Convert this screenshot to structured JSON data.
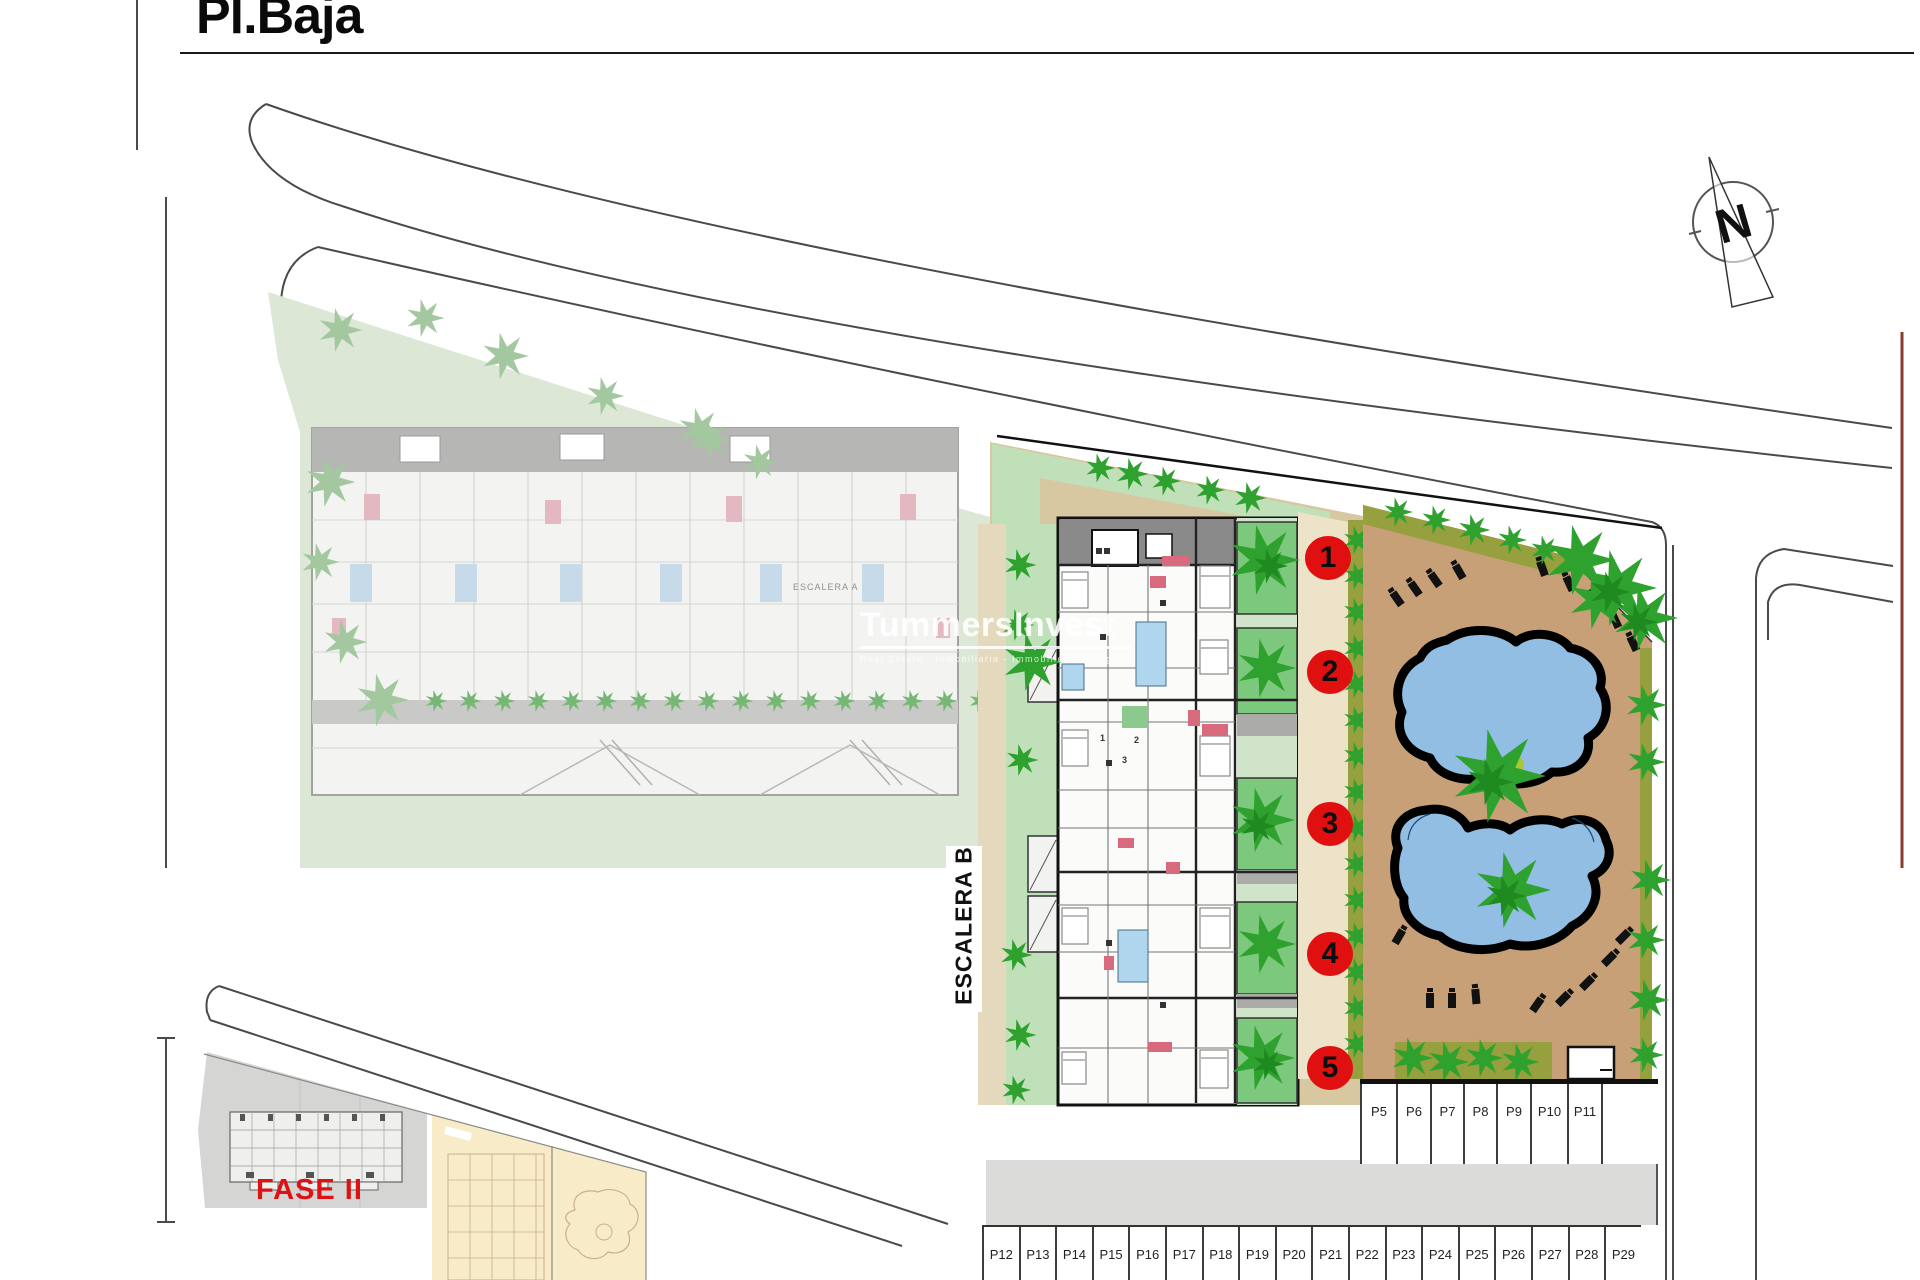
{
  "title": "Pl.Baja",
  "compass": {
    "letter": "N"
  },
  "watermark": {
    "brand": "TummersInvest",
    "tagline": "Real Estate - Inmobiliaria - Immobilien - Vastgoed"
  },
  "labels": {
    "escalera_b": "ESCALERA B",
    "escalera_a": "ESCALERA A",
    "fase2": "FASE II"
  },
  "unit_markers": [
    "1",
    "2",
    "3",
    "4",
    "5"
  ],
  "building_numbers": [
    "1",
    "2",
    "3"
  ],
  "parking_upper": [
    "P5",
    "P6",
    "P7",
    "P8",
    "P9",
    "P10",
    "P11"
  ],
  "parking_lower": [
    "P12",
    "P13",
    "P14",
    "P15",
    "P16",
    "P17",
    "P18",
    "P19",
    "P20",
    "P21",
    "P22",
    "P23",
    "P24",
    "P25",
    "P26",
    "P27",
    "P28",
    "P29"
  ],
  "colors": {
    "marker_red": "#E01010",
    "fase_red": "#DE1212",
    "pool_blue": "#92BEE4",
    "deck_tan": "#C7A078",
    "parcel_beige": "#D8C8A2",
    "hedge_olive": "#97A03E",
    "bush_green": "#2EA12E",
    "patio_green": "#7CC87C",
    "faded_green": "#A3C8A0",
    "walkway_cream": "#EDE3C8"
  }
}
